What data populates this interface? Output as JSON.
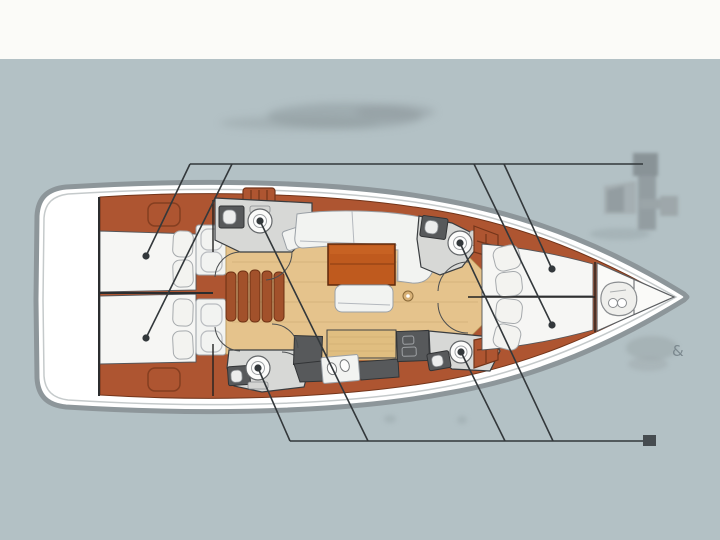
{
  "scene": {
    "type": "sailing-yacht-interior-deck-plan",
    "orientation": "bow-right",
    "cabins": 4,
    "heads": 4
  },
  "watermark": {
    "amp": "&"
  },
  "colors": {
    "bg": "#b3c1c5",
    "band": "#fbfbf8",
    "hullStroke": "#8d969a",
    "deckWhite": "#ffffff",
    "deckLine": "#c5cacb",
    "wood": "#ae5531",
    "woodDark": "#73351a",
    "sole": "#e5c38c",
    "soleLine": "#c9a76e",
    "headFloor": "#d7d8d6",
    "unitDark": "#57595b",
    "furnWhite": "#f2f3f1",
    "furnStroke": "#9aa0a6",
    "tableWood": "#bf5a1e",
    "stepWood": "#a2512b",
    "callout": "#33383b",
    "markerDark": "#464c50",
    "blurGray": "#97a1a4",
    "watermark": "#8c979b",
    "textFaint": "#76838a"
  },
  "callouts": {
    "top_bar": {
      "x1": 190,
      "y1": 164,
      "x2": 643,
      "y2": 164
    },
    "bottom_bar": {
      "x1": 290,
      "y1": 441,
      "x2": 655,
      "y2": 441
    },
    "lines": [
      {
        "x1": 190,
        "y1": 164,
        "x2": 146,
        "y2": 256
      },
      {
        "x1": 232,
        "y1": 164,
        "x2": 146,
        "y2": 338
      },
      {
        "x1": 474,
        "y1": 164,
        "x2": 552,
        "y2": 325
      },
      {
        "x1": 504,
        "y1": 164,
        "x2": 552,
        "y2": 269
      },
      {
        "x1": 258,
        "y1": 368,
        "x2": 290,
        "y2": 441
      },
      {
        "x1": 260,
        "y1": 221,
        "x2": 368,
        "y2": 441
      },
      {
        "x1": 461,
        "y1": 352,
        "x2": 505,
        "y2": 441
      },
      {
        "x1": 460,
        "y1": 243,
        "x2": 553,
        "y2": 441
      }
    ],
    "dots": [
      {
        "x": 146,
        "y": 256,
        "target": "aft-cabin-port-berth"
      },
      {
        "x": 146,
        "y": 338,
        "target": "aft-cabin-starboard-berth"
      },
      {
        "x": 552,
        "y": 269,
        "target": "forward-cabin-port-berth"
      },
      {
        "x": 552,
        "y": 325,
        "target": "forward-cabin-starboard-berth"
      },
      {
        "x": 260,
        "y": 221,
        "target": "port-head-toilet"
      },
      {
        "x": 258,
        "y": 368,
        "target": "starboard-head-toilet"
      },
      {
        "x": 460,
        "y": 243,
        "target": "forward-port-head-toilet"
      },
      {
        "x": 461,
        "y": 352,
        "target": "forward-starboard-head-toilet"
      }
    ],
    "end_marker": {
      "x": 643,
      "y": 435,
      "w": 13,
      "h": 11
    }
  }
}
